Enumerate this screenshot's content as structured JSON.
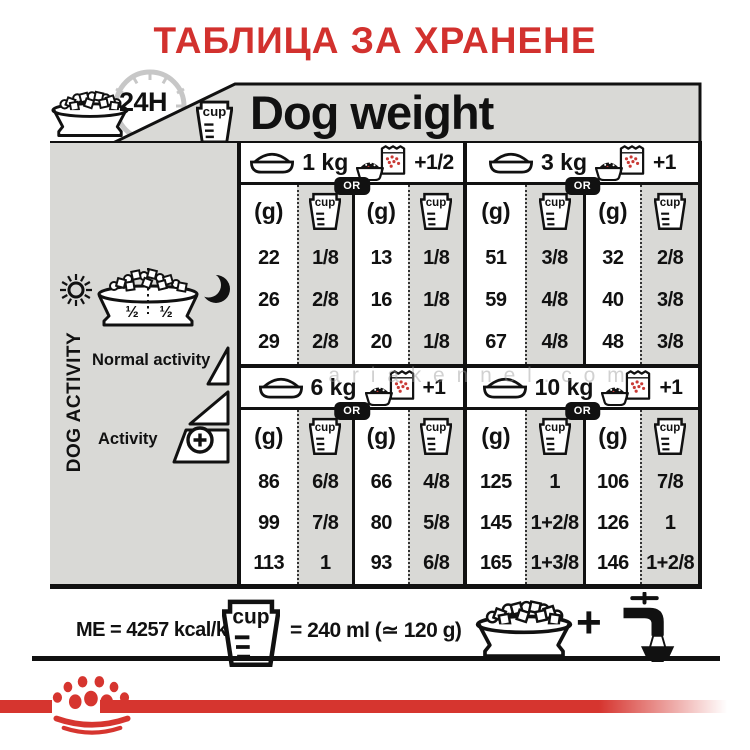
{
  "title": "ТАБЛИЦА ЗА ХРАНЕНЕ",
  "header": {
    "daily_ration_label": "24H",
    "dog_weight_label": "Dog weight"
  },
  "sidebar": {
    "dog_activity_label": "DOG ACTIVITY",
    "normal_activity_label": "Normal activity",
    "activity_label": "Activity",
    "half_left": "½",
    "half_right": "½"
  },
  "table": {
    "or_label": "OR",
    "grams_label": "(g)",
    "cup_label": "cup",
    "sections": [
      {
        "weight": "1 kg",
        "extra": "+1/2",
        "rows": [
          [
            "22",
            "1/8",
            "13",
            "1/8"
          ],
          [
            "26",
            "2/8",
            "16",
            "1/8"
          ],
          [
            "29",
            "2/8",
            "20",
            "1/8"
          ]
        ]
      },
      {
        "weight": "3 kg",
        "extra": "+1",
        "rows": [
          [
            "51",
            "3/8",
            "32",
            "2/8"
          ],
          [
            "59",
            "4/8",
            "40",
            "3/8"
          ],
          [
            "67",
            "4/8",
            "48",
            "3/8"
          ]
        ]
      },
      {
        "weight": "6 kg",
        "extra": "+1",
        "rows": [
          [
            "86",
            "6/8",
            "66",
            "4/8"
          ],
          [
            "99",
            "7/8",
            "80",
            "5/8"
          ],
          [
            "113",
            "1",
            "93",
            "6/8"
          ]
        ]
      },
      {
        "weight": "10 kg",
        "extra": "+1",
        "rows": [
          [
            "125",
            "1",
            "106",
            "7/8"
          ],
          [
            "145",
            "1+2/8",
            "126",
            "1"
          ],
          [
            "165",
            "1+3/8",
            "146",
            "1+2/8"
          ]
        ]
      }
    ]
  },
  "footer": {
    "me_label": "ME = 4257 kcal/kg",
    "cup_equivalence": "= 240 ml (≃ 120 g)",
    "plus_sign": "+"
  },
  "watermark": "a r i a k e n n e l . c o m",
  "colors": {
    "accent_red": "#d2312e",
    "stripe_red": "#d6352f",
    "table_gray": "#d9d9d6"
  }
}
